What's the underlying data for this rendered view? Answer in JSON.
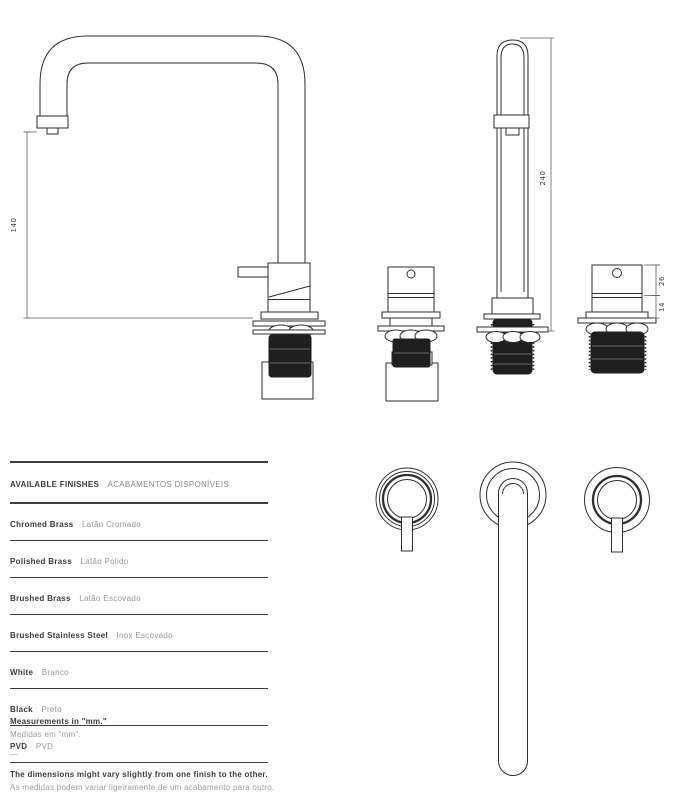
{
  "drawing": {
    "dimensions": {
      "front_height": "140",
      "side_height": "240",
      "valve_body_height": "26",
      "valve_base_height": "14"
    }
  },
  "finishes": {
    "title_en": "AVAILABLE FINISHES",
    "title_pt": "ACABAMENTOS DISPONÍVEIS",
    "rows": [
      {
        "en": "Chromed Brass",
        "pt": "Latão Cromado"
      },
      {
        "en": "Polished Brass",
        "pt": "Latão Polido"
      },
      {
        "en": "Brushed Brass",
        "pt": "Latão Escovado"
      },
      {
        "en": "Brushed Stainless Steel",
        "pt": "Inox Escovado"
      },
      {
        "en": "White",
        "pt": "Branco"
      },
      {
        "en": "Black",
        "pt": "Preto"
      },
      {
        "en": "PVD",
        "pt": "PVD"
      }
    ]
  },
  "notes": {
    "measurements_en": "Measurements in \"mm.\"",
    "measurements_pt": "Medidas em \"mm\".",
    "divider": "—",
    "tolerance_en": "The dimensions might vary slightly from one finish to the other.",
    "tolerance_pt": "As medidas podem variar ligeiramente de um acabamento para outro."
  }
}
